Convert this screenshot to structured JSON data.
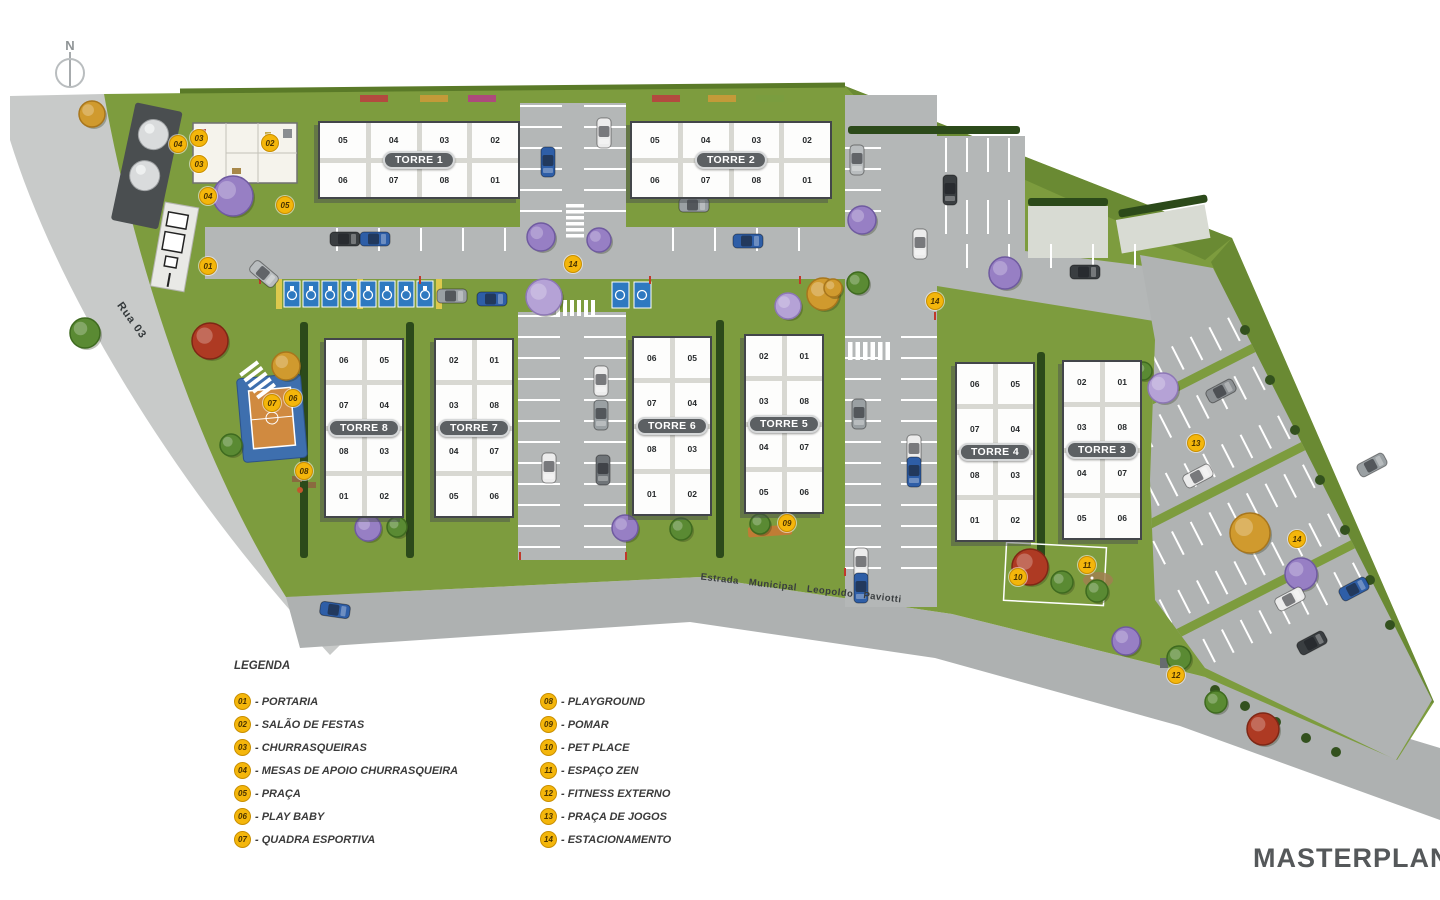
{
  "title": "MASTERPLAN",
  "north_label": "N",
  "roads": {
    "rua_label": "Rua 03",
    "estrada_label": "Estrada  Municipal  Leopoldo  Paviotti"
  },
  "legend": {
    "title": "LEGENDA",
    "items": [
      {
        "num": "01",
        "label": "PORTARIA"
      },
      {
        "num": "02",
        "label": "SALÃO DE FESTAS"
      },
      {
        "num": "03",
        "label": "CHURRASQUEIRAS"
      },
      {
        "num": "04",
        "label": "MESAS DE APOIO CHURRASQUEIRA"
      },
      {
        "num": "05",
        "label": "PRAÇA"
      },
      {
        "num": "06",
        "label": "PLAY BABY"
      },
      {
        "num": "07",
        "label": "QUADRA ESPORTIVA"
      },
      {
        "num": "08",
        "label": "PLAYGROUND"
      },
      {
        "num": "09",
        "label": "POMAR"
      },
      {
        "num": "10",
        "label": "PET PLACE"
      },
      {
        "num": "11",
        "label": "ESPAÇO ZEN"
      },
      {
        "num": "12",
        "label": "FITNESS EXTERNO"
      },
      {
        "num": "13",
        "label": "PRAÇA DE JOGOS"
      },
      {
        "num": "14",
        "label": "ESTACIONAMENTO"
      }
    ]
  },
  "towers": [
    {
      "name": "TORRE 1",
      "type": "h",
      "x": 318,
      "y": 121,
      "rows": [
        [
          "05",
          "04",
          "03",
          "02"
        ],
        [
          "06",
          "07",
          "08",
          "01"
        ]
      ]
    },
    {
      "name": "TORRE 2",
      "type": "h",
      "x": 630,
      "y": 121,
      "rows": [
        [
          "05",
          "04",
          "03",
          "02"
        ],
        [
          "06",
          "07",
          "08",
          "01"
        ]
      ]
    },
    {
      "name": "TORRE 8",
      "type": "v",
      "x": 324,
      "y": 338,
      "rows": [
        [
          "06",
          "05"
        ],
        [
          "07",
          "04"
        ],
        [
          "08",
          "03"
        ],
        [
          "01",
          "02"
        ]
      ]
    },
    {
      "name": "TORRE 7",
      "type": "v",
      "x": 434,
      "y": 338,
      "rows": [
        [
          "02",
          "01"
        ],
        [
          "03",
          "08"
        ],
        [
          "04",
          "07"
        ],
        [
          "05",
          "06"
        ]
      ]
    },
    {
      "name": "TORRE 6",
      "type": "v",
      "x": 632,
      "y": 336,
      "rows": [
        [
          "06",
          "05"
        ],
        [
          "07",
          "04"
        ],
        [
          "08",
          "03"
        ],
        [
          "01",
          "02"
        ]
      ]
    },
    {
      "name": "TORRE 5",
      "type": "v",
      "x": 744,
      "y": 334,
      "rows": [
        [
          "02",
          "01"
        ],
        [
          "03",
          "08"
        ],
        [
          "04",
          "07"
        ],
        [
          "05",
          "06"
        ]
      ]
    },
    {
      "name": "TORRE 4",
      "type": "v",
      "x": 955,
      "y": 362,
      "rows": [
        [
          "06",
          "05"
        ],
        [
          "07",
          "04"
        ],
        [
          "08",
          "03"
        ],
        [
          "01",
          "02"
        ]
      ]
    },
    {
      "name": "TORRE 3",
      "type": "v",
      "x": 1062,
      "y": 360,
      "rows": [
        [
          "02",
          "01"
        ],
        [
          "03",
          "08"
        ],
        [
          "04",
          "07"
        ],
        [
          "05",
          "06"
        ]
      ]
    }
  ],
  "markers": [
    {
      "num": "01",
      "x": 208,
      "y": 266
    },
    {
      "num": "02",
      "x": 270,
      "y": 143
    },
    {
      "num": "03",
      "x": 199,
      "y": 138
    },
    {
      "num": "03",
      "x": 199,
      "y": 164
    },
    {
      "num": "04",
      "x": 178,
      "y": 144
    },
    {
      "num": "04",
      "x": 208,
      "y": 196
    },
    {
      "num": "05",
      "x": 285,
      "y": 205
    },
    {
      "num": "06",
      "x": 293,
      "y": 398
    },
    {
      "num": "07",
      "x": 272,
      "y": 403
    },
    {
      "num": "08",
      "x": 304,
      "y": 471
    },
    {
      "num": "09",
      "x": 787,
      "y": 523
    },
    {
      "num": "10",
      "x": 1018,
      "y": 577
    },
    {
      "num": "11",
      "x": 1087,
      "y": 565
    },
    {
      "num": "12",
      "x": 1176,
      "y": 675
    },
    {
      "num": "13",
      "x": 1196,
      "y": 443
    },
    {
      "num": "14",
      "x": 573,
      "y": 264
    },
    {
      "num": "14",
      "x": 935,
      "y": 301
    },
    {
      "num": "14",
      "x": 1297,
      "y": 539
    }
  ],
  "colors": {
    "grass": "#7d9c3e",
    "grass_dark": "#6a8a33",
    "hedge": "#2c4a1a",
    "road": "#b4b7b7",
    "road_outer": "#c8cac9",
    "estrada": "#aeb1b1",
    "building": "#fdfdfc",
    "tower_capsule": "#5c6063",
    "marker_yellow": "#f4b60b",
    "accessible_blue": "#2e79c0",
    "court_blue": "#3e6fae",
    "court_orange": "#d08a40"
  }
}
